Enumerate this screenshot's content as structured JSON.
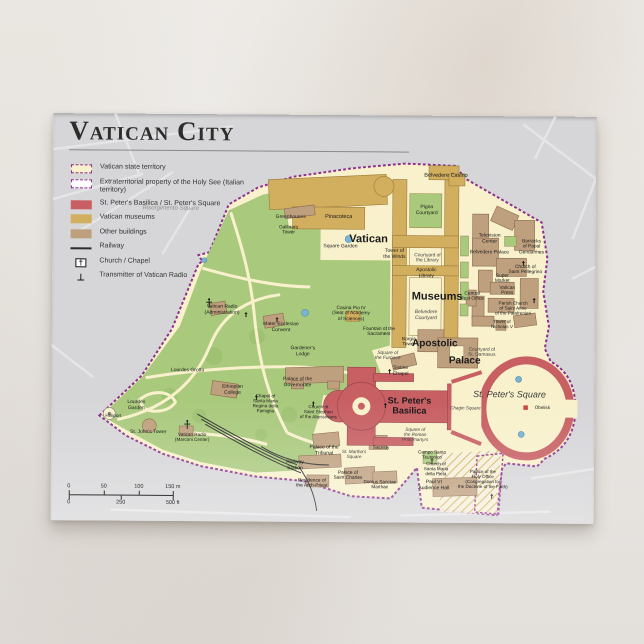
{
  "card": {
    "title": "Vatican City",
    "legend": [
      {
        "swatch": "territory",
        "label": "Vatican state territory"
      },
      {
        "swatch": "extraterritorial",
        "label": "Extraterritorial property of the Holy See (Italian territory)"
      },
      {
        "swatch": "basilica",
        "label": "St. Peter's Basilica / St. Peter's Square"
      },
      {
        "swatch": "museums",
        "label": "Vatican museums"
      },
      {
        "swatch": "buildings",
        "label": "Other buildings"
      },
      {
        "swatch": "railway",
        "label": "Railway"
      },
      {
        "swatch": "church",
        "label": "Church / Chapel"
      },
      {
        "swatch": "transmitter",
        "label": "Transmitter of Vatican Radio"
      }
    ],
    "colors": {
      "territory": "#f8f1cc",
      "gardens": "#a9c97c",
      "museums": "#d2ae5f",
      "buildings": "#bfa07e",
      "basilica_red": "#c75f63",
      "border_purple": "#8e2f8e",
      "map_background": "#d6d6d8",
      "water": "#7ab4d4",
      "railway": "#2b2b2b"
    },
    "scalebar": {
      "m": [
        "0",
        "50",
        "100",
        "150 m"
      ],
      "ft": [
        "0",
        "250",
        "500 ft"
      ]
    },
    "labels": [
      {
        "text": "Vatican",
        "x": 316,
        "y": 124,
        "size": 11,
        "weight": "bold"
      },
      {
        "text": "Museums",
        "x": 385,
        "y": 181,
        "size": 11,
        "weight": "bold"
      },
      {
        "text": "Apostolic",
        "x": 383,
        "y": 228,
        "size": 10,
        "weight": "bold"
      },
      {
        "text": "Palace",
        "x": 413,
        "y": 245,
        "size": 10,
        "weight": "bold"
      },
      {
        "text": "St. Peter's\nBasilica",
        "x": 358,
        "y": 290,
        "size": 9,
        "weight": "bold"
      },
      {
        "text": "St. Peter's Square",
        "x": 458,
        "y": 278,
        "size": 9,
        "style": "italic",
        "color": "#3c3c3c"
      },
      {
        "text": "Belvedere Casino",
        "x": 393,
        "y": 60,
        "size": 5.5
      },
      {
        "text": "Pinacoteca",
        "x": 286,
        "y": 102,
        "size": 5.5
      },
      {
        "text": "Square Garden",
        "x": 288,
        "y": 132,
        "size": 5
      },
      {
        "text": "Pigna\nCourtyard",
        "x": 374,
        "y": 95,
        "size": 5
      },
      {
        "text": "Tower of\nthe Winds",
        "x": 342,
        "y": 139,
        "size": 5
      },
      {
        "text": "Courtyard of\nthe Library",
        "x": 375,
        "y": 143,
        "size": 4.8,
        "color": "#444444"
      },
      {
        "text": "Apostolic\nLibrary",
        "x": 374,
        "y": 158,
        "size": 5
      },
      {
        "text": "Belvedere\nCourtyard",
        "x": 374,
        "y": 200,
        "size": 5,
        "style": "italic",
        "color": "#444444"
      },
      {
        "text": "Casina Pio IV\n(Seat of Academy\nof Sciences)",
        "x": 299,
        "y": 199,
        "size": 4.8
      },
      {
        "text": "Fountain of the\nSacrament",
        "x": 327,
        "y": 217,
        "size": 4.8
      },
      {
        "text": "Sistine\nChapel",
        "x": 349,
        "y": 256,
        "size": 5
      },
      {
        "text": "Borgia\nTower",
        "x": 357,
        "y": 227,
        "size": 4.8
      },
      {
        "text": "Square of\nthe Furnace",
        "x": 336,
        "y": 241,
        "size": 4.8,
        "style": "italic",
        "color": "#444444"
      },
      {
        "text": "Courtyard of\nSt. Damasus",
        "x": 430,
        "y": 237,
        "size": 4.8,
        "color": "#444444"
      },
      {
        "text": "Greenhouses",
        "x": 238,
        "y": 103,
        "size": 5
      },
      {
        "text": "Gallinaro\nTower",
        "x": 236,
        "y": 116,
        "size": 4.8
      },
      {
        "text": "Television\nCenter",
        "x": 437,
        "y": 123,
        "size": 5
      },
      {
        "text": "Belvedere Palace",
        "x": 437,
        "y": 137,
        "size": 5
      },
      {
        "text": "Barracks\nof Papal\nGendarmes",
        "x": 479,
        "y": 131,
        "size": 4.8
      },
      {
        "text": "Church of\nSaint Pellegrino",
        "x": 473,
        "y": 154,
        "size": 4.8
      },
      {
        "text": "Central\nPost Office",
        "x": 420,
        "y": 181,
        "size": 4.8
      },
      {
        "text": "Super\nMarket",
        "x": 450,
        "y": 163,
        "size": 4.8
      },
      {
        "text": "Vatican\nPress",
        "x": 455,
        "y": 175,
        "size": 4.8
      },
      {
        "text": "Parish Church\nof Saint Anne\nof the Palafrenieri",
        "x": 461,
        "y": 192,
        "size": 4.6
      },
      {
        "text": "Tower of\nNicholas V",
        "x": 450,
        "y": 208,
        "size": 4.6
      },
      {
        "text": "Vatican Radio\n(Administration)",
        "x": 170,
        "y": 196,
        "size": 5
      },
      {
        "text": "Mater Ecclesiae\nConvent",
        "x": 229,
        "y": 213,
        "size": 5
      },
      {
        "text": "Gardener's\nLodge",
        "x": 251,
        "y": 237,
        "size": 5
      },
      {
        "text": "Palace of the\nGovernorate",
        "x": 246,
        "y": 268,
        "size": 5
      },
      {
        "text": "Chapel of\nSanta Maria\nRegina della\nFamiglia",
        "x": 214,
        "y": 289,
        "size": 4.6
      },
      {
        "text": "Church of\nSaint Stephen\nof the Abyssinians",
        "x": 267,
        "y": 297,
        "size": 4.6
      },
      {
        "text": "Ethiopian\nCollege",
        "x": 181,
        "y": 276,
        "size": 5
      },
      {
        "text": "Lourdes Grotto",
        "x": 136,
        "y": 257,
        "size": 5
      },
      {
        "text": "Lourdes\nGarden",
        "x": 85,
        "y": 292,
        "size": 5
      },
      {
        "text": "Heliport",
        "x": 62,
        "y": 302,
        "size": 4.6
      },
      {
        "text": "St. John's Tower",
        "x": 97,
        "y": 319,
        "size": 5
      },
      {
        "text": "Vatican Radio\n(Marconi Center)",
        "x": 141,
        "y": 323,
        "size": 4.6
      },
      {
        "text": "Railway\nStation",
        "x": 244,
        "y": 351,
        "size": 5
      },
      {
        "text": "Palace of the\nTribunal",
        "x": 273,
        "y": 336,
        "size": 5
      },
      {
        "text": "St. Martha's\nSquare",
        "x": 303,
        "y": 339,
        "size": 4.6,
        "style": "italic",
        "color": "#444444"
      },
      {
        "text": "Residence of\nthe Arch-Priest",
        "x": 261,
        "y": 369,
        "size": 4.8
      },
      {
        "text": "Palace of\nSaint Charles",
        "x": 297,
        "y": 361,
        "size": 4.8
      },
      {
        "text": "Domus Sanctae\nMarthae",
        "x": 329,
        "y": 369,
        "size": 4.6
      },
      {
        "text": "Sacristy",
        "x": 330,
        "y": 332,
        "size": 4.6
      },
      {
        "text": "Square of\nthe Roman\nProtomartyrs",
        "x": 364,
        "y": 319,
        "size": 4.6,
        "style": "italic",
        "color": "#444444"
      },
      {
        "text": "Campo Santo\nTeutonico",
        "x": 381,
        "y": 339,
        "size": 4.6
      },
      {
        "text": "Church of\nSanta Maria\ndella Pietà",
        "x": 385,
        "y": 353,
        "size": 4.5
      },
      {
        "text": "Paul VI\nAudience Hall",
        "x": 383,
        "y": 370,
        "size": 5
      },
      {
        "text": "Palace of the\nHoly Office\n(Congregation for\nthe Doctrine of the Faith)",
        "x": 432,
        "y": 363,
        "size": 4.5
      },
      {
        "text": "Obelisk",
        "x": 491,
        "y": 291,
        "size": 4.6
      },
      {
        "text": "Chagin Square",
        "x": 414,
        "y": 292,
        "size": 4.6,
        "style": "italic",
        "color": "#444444"
      },
      {
        "text": "Risorgimento Square",
        "x": 118,
        "y": 95,
        "size": 6,
        "style": "italic",
        "color": "#8f8d8c"
      }
    ]
  }
}
